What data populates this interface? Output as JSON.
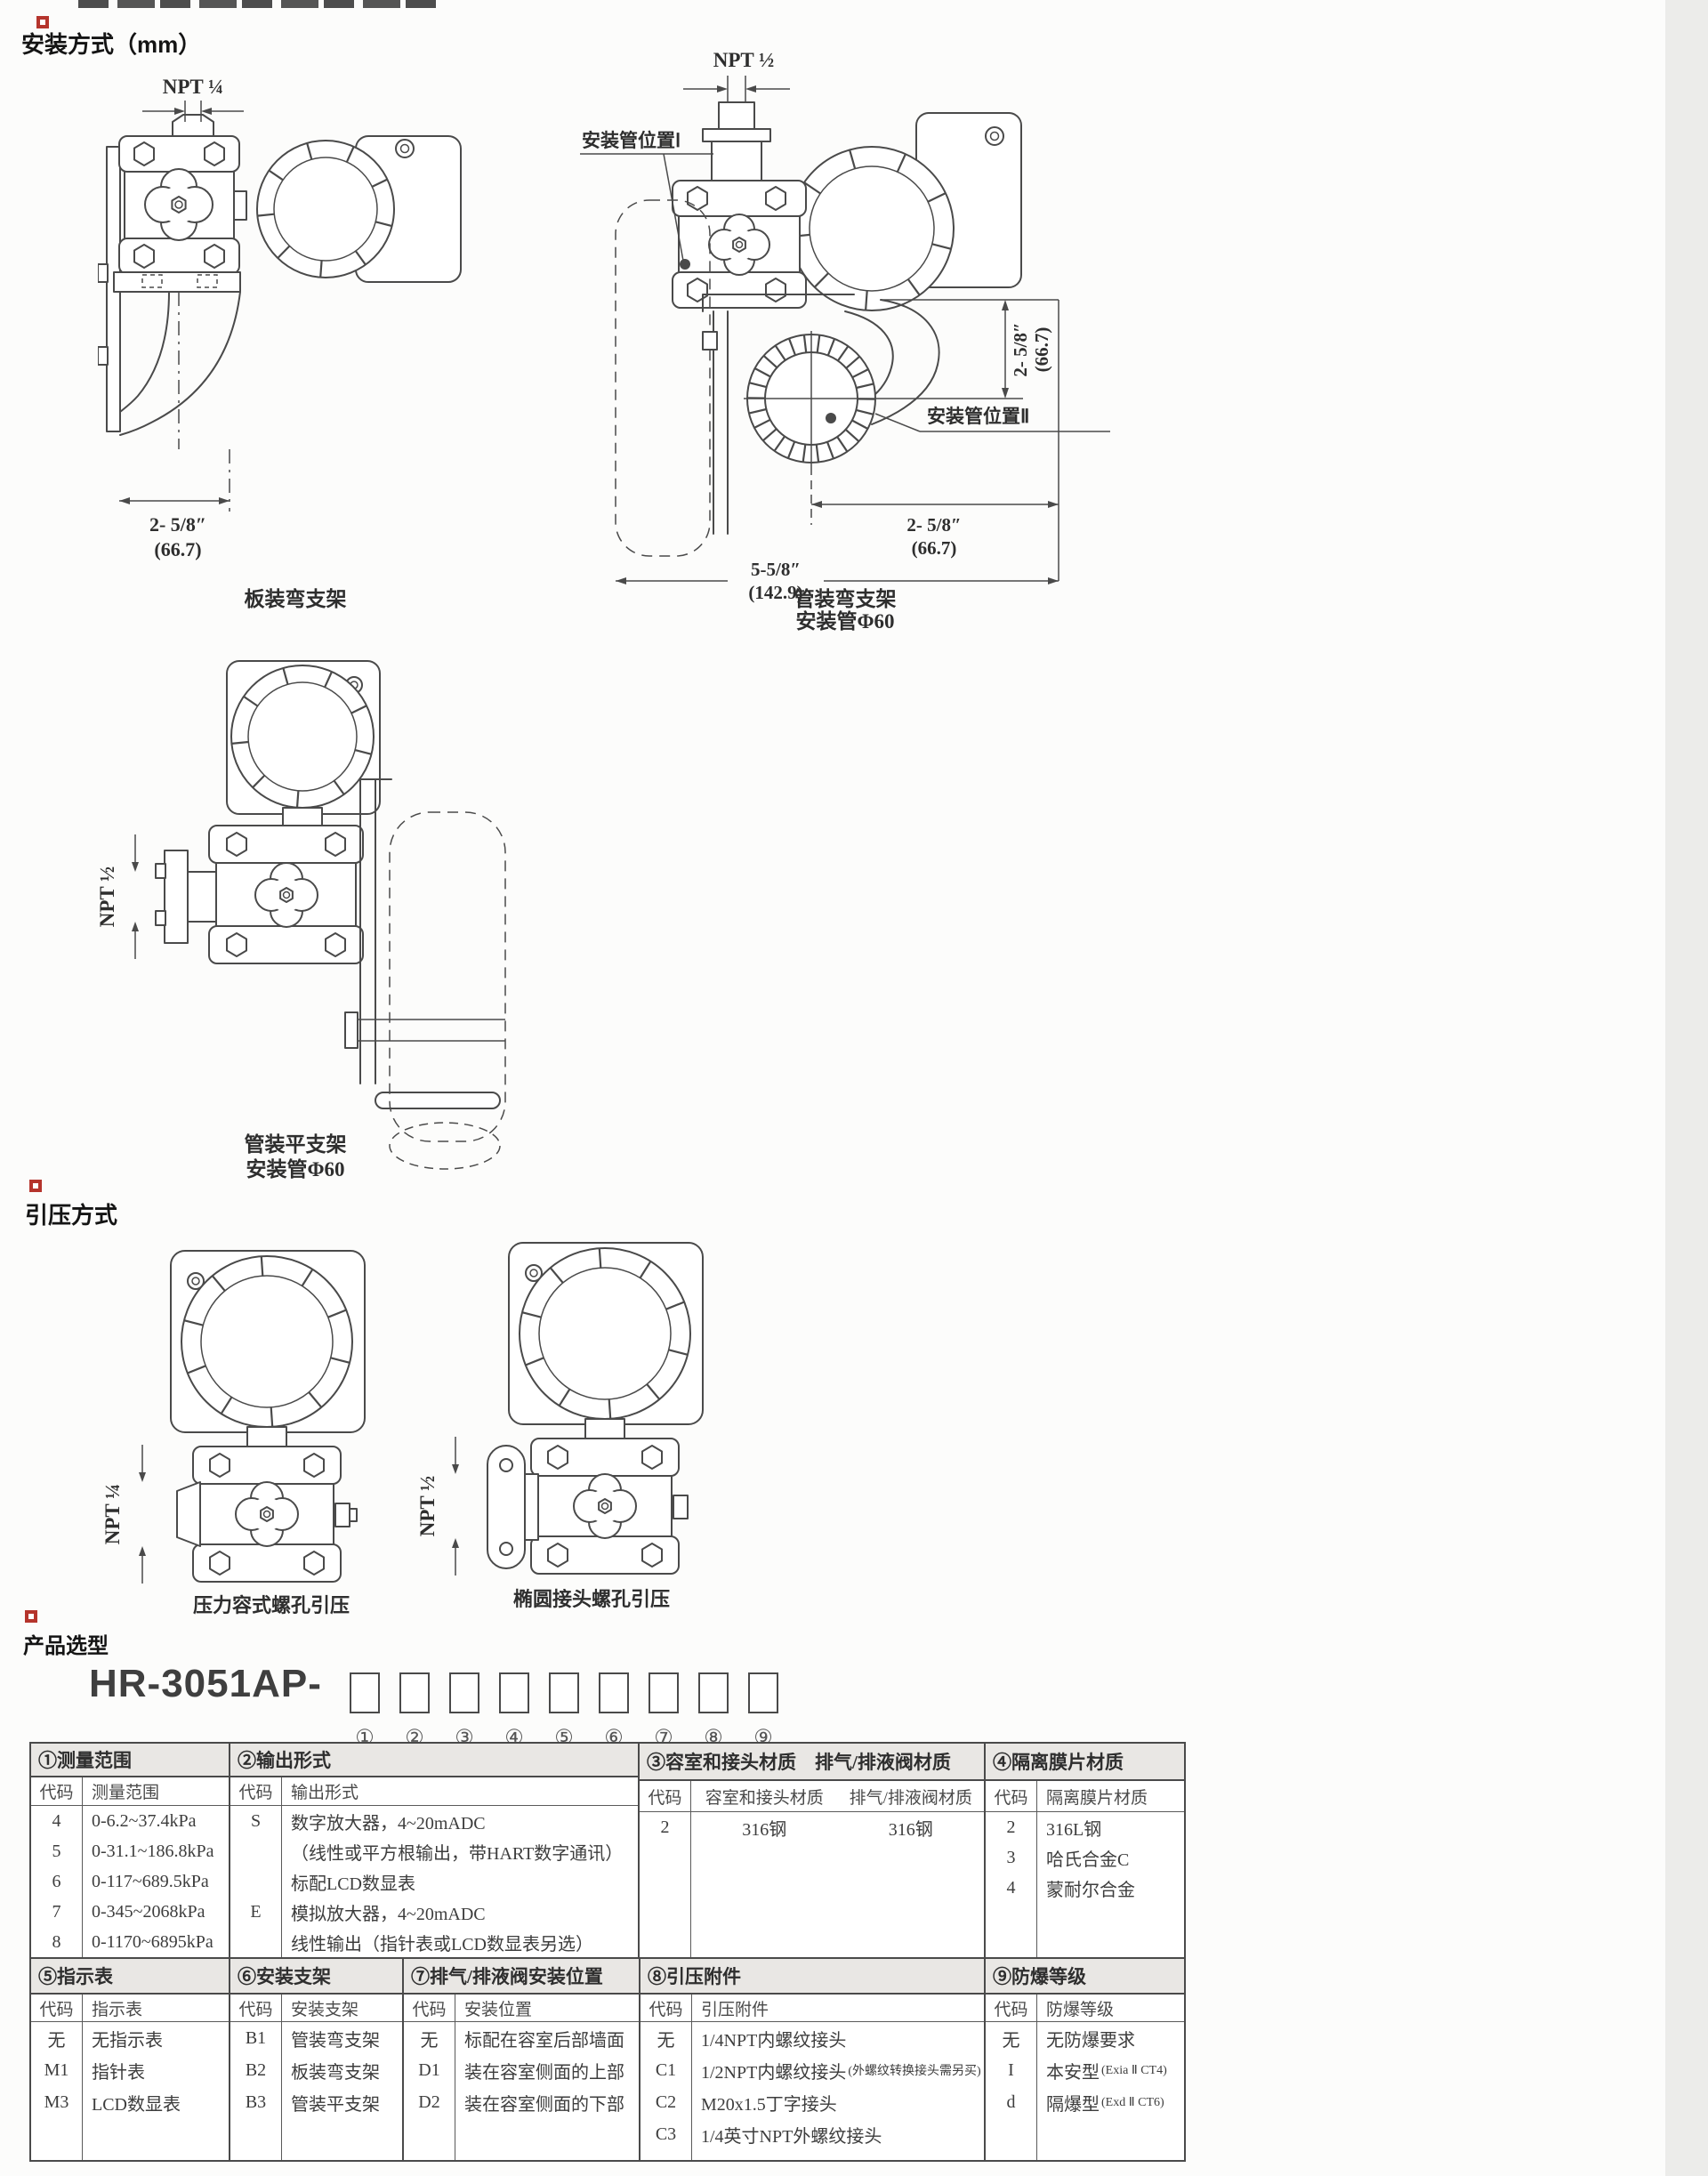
{
  "sections": {
    "mounting": {
      "title": "安装方式（mm）",
      "panel_bracket": {
        "npt": "NPT ¼",
        "dim_in": "2- 5/8″",
        "dim_mm": "(66.7)",
        "caption": "板装弯支架"
      },
      "pipe_bent": {
        "npt": "NPT ½",
        "pipe_pos_1": "安装管位置Ⅰ",
        "pipe_pos_2": "安装管位置Ⅱ",
        "dim_v_in": "2- 5/8″",
        "dim_v_mm": "(66.7)",
        "dim_h1_in": "2- 5/8″",
        "dim_h1_mm": "(66.7)",
        "dim_h2_in": "5-5/8″",
        "dim_h2_mm": "(142.9)",
        "caption_1": "管装弯支架",
        "caption_2": "安装管Φ60"
      },
      "pipe_flat": {
        "npt": "NPT ½",
        "caption_1": "管装平支架",
        "caption_2": "安装管Φ60"
      }
    },
    "pressure_tap": {
      "title": "引压方式",
      "vessel": {
        "npt": "NPT ¼",
        "caption": "压力容式螺孔引压"
      },
      "oval": {
        "npt": "NPT ½",
        "caption": "椭圆接头螺孔引压"
      }
    },
    "selection": {
      "title": "产品选型",
      "model_prefix": "HR-3051AP-",
      "positions": [
        "①",
        "②",
        "③",
        "④",
        "⑤",
        "⑥",
        "⑦",
        "⑧",
        "⑨"
      ]
    }
  },
  "tables": {
    "band1": {
      "measure": {
        "header": "①测量范围",
        "sub_code": "代码",
        "sub_label": "测量范围",
        "rows": [
          {
            "code": "4",
            "text": "0-6.2~37.4kPa"
          },
          {
            "code": "5",
            "text": "0-31.1~186.8kPa"
          },
          {
            "code": "6",
            "text": "0-117~689.5kPa"
          },
          {
            "code": "7",
            "text": "0-345~2068kPa"
          },
          {
            "code": "8",
            "text": "0-1170~6895kPa"
          }
        ]
      },
      "output": {
        "header": "②输出形式",
        "sub_code": "代码",
        "sub_label": "输出形式",
        "rows": [
          {
            "code": "S",
            "text": "数字放大器，4~20mADC"
          },
          {
            "code": "",
            "text": "（线性或平方根输出，带HART数字通讯）"
          },
          {
            "code": "",
            "text": "标配LCD数显表"
          },
          {
            "code": "E",
            "text": "模拟放大器，4~20mADC"
          },
          {
            "code": "",
            "text": "线性输出（指针表或LCD数显表另选）"
          }
        ]
      },
      "body_material": {
        "header": "③容室和接头材质　排气/排液阀材质",
        "sub_code": "代码",
        "sub_label_1": "容室和接头材质",
        "sub_label_2": "排气/排液阀材质",
        "rows": [
          {
            "code": "2",
            "text_1": "316钢",
            "text_2": "316钢"
          }
        ]
      },
      "diaphragm": {
        "header": "④隔离膜片材质",
        "sub_code": "代码",
        "sub_label": "隔离膜片材质",
        "rows": [
          {
            "code": "2",
            "text": "316L钢"
          },
          {
            "code": "3",
            "text": "哈氏合金C"
          },
          {
            "code": "4",
            "text": "蒙耐尔合金"
          }
        ]
      }
    },
    "band2": {
      "indicator": {
        "header": "⑤指示表",
        "sub_code": "代码",
        "sub_label": "指示表",
        "rows": [
          {
            "code": "无",
            "text": "无指示表"
          },
          {
            "code": "M1",
            "text": "指针表"
          },
          {
            "code": "M3",
            "text": "LCD数显表"
          }
        ]
      },
      "bracket": {
        "header": "⑥安装支架",
        "sub_code": "代码",
        "sub_label": "安装支架",
        "rows": [
          {
            "code": "B1",
            "text": "管装弯支架"
          },
          {
            "code": "B2",
            "text": "板装弯支架"
          },
          {
            "code": "B3",
            "text": "管装平支架"
          }
        ]
      },
      "valve_position": {
        "header": "⑦排气/排液阀安装位置",
        "sub_code": "代码",
        "sub_label": "安装位置",
        "rows": [
          {
            "code": "无",
            "text": "标配在容室后部墙面"
          },
          {
            "code": "D1",
            "text": "装在容室侧面的上部"
          },
          {
            "code": "D2",
            "text": "装在容室侧面的下部"
          }
        ]
      },
      "fitting": {
        "header": "⑧引压附件",
        "sub_code": "代码",
        "sub_label": "引压附件",
        "rows": [
          {
            "code": "无",
            "text": "1/4NPT内螺纹接头",
            "note": ""
          },
          {
            "code": "C1",
            "text": "1/2NPT内螺纹接头",
            "note": "(外螺纹转换接头需另买)"
          },
          {
            "code": "C2",
            "text": "M20x1.5丁字接头",
            "note": ""
          },
          {
            "code": "C3",
            "text": "1/4英寸NPT外螺纹接头",
            "note": ""
          }
        ]
      },
      "explosion": {
        "header": "⑨防爆等级",
        "sub_code": "代码",
        "sub_label": "防爆等级",
        "rows": [
          {
            "code": "无",
            "text": "无防爆要求",
            "note": ""
          },
          {
            "code": "I",
            "text": "本安型",
            "note": "(Exia Ⅱ CT4)"
          },
          {
            "code": "d",
            "text": "隔爆型",
            "note": "(Exd Ⅱ CT6)"
          }
        ]
      }
    }
  },
  "colors": {
    "accent_red": "#b5342c",
    "line": "#4a4a4a",
    "table_header_bg": "#e9e7e4"
  }
}
